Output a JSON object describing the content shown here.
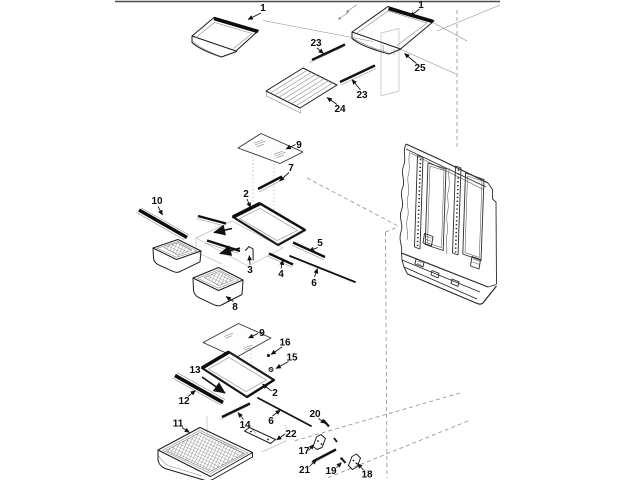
{
  "diagram": {
    "background": "#ffffff",
    "line_color": "#1a1a1a",
    "projection_line_color": "#999999",
    "callouts": {
      "c1a": "1",
      "c1b": "1",
      "c23a": "23",
      "c23b": "23",
      "c24": "24",
      "c25": "25",
      "c9a": "9",
      "c7": "7",
      "c2a": "2",
      "c10": "10",
      "c3": "3",
      "c4": "4",
      "c5": "5",
      "c6a": "6",
      "c8": "8",
      "c9b": "9",
      "c16": "16",
      "c15": "15",
      "c13": "13",
      "c2b": "2",
      "c12": "12",
      "c14": "14",
      "c11": "11",
      "c6b": "6",
      "c22": "22",
      "c20": "20",
      "c17": "17",
      "c21": "21",
      "c19": "19",
      "c18": "18"
    }
  }
}
